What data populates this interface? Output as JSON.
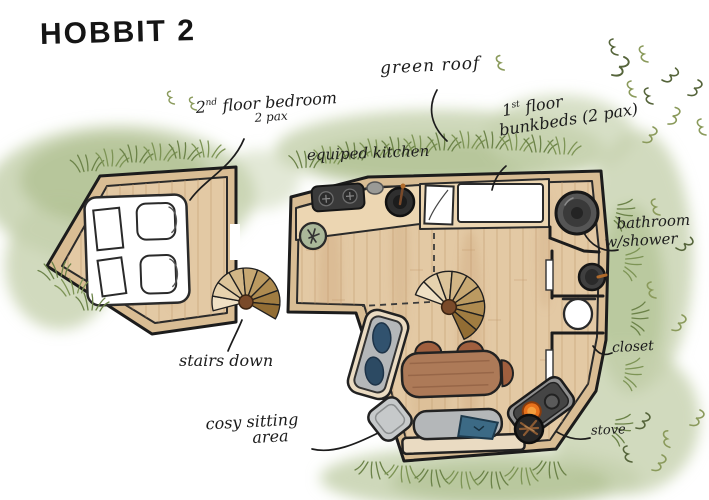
{
  "title": "HOBBIT 2",
  "labels": {
    "bedroom": {
      "ordinal": "2",
      "suffix": "nd",
      "rest": " floor bedroom",
      "capacity": "2 pax"
    },
    "green_roof": "green roof",
    "kitchen": "equiped kitchen",
    "bunkbeds": {
      "ordinal": "1",
      "suffix": "st",
      "rest": " floor",
      "line2": "bunkbeds (2 pax)"
    },
    "bathroom": {
      "line1": "bathroom",
      "line2": "w/shower"
    },
    "closet": "closet",
    "stairs": "stairs down",
    "sitting": {
      "line1": "cosy sitting",
      "line2": "area"
    },
    "stove": "stove"
  },
  "fixtures": [
    "double bed",
    "spiral stairs",
    "kitchen counter",
    "cooktop",
    "kitchen sink",
    "side table",
    "bunk bed",
    "shower",
    "washbasin",
    "toilet",
    "sofa",
    "ottoman",
    "dining table",
    "chairs",
    "bench",
    "wood stove",
    "firewood basket"
  ],
  "colors": {
    "ink": "#1f1f1f",
    "paper": "#ffffff",
    "wall_tan": "#d9bd94",
    "wood_floor": "#e3c9a4",
    "wood_grain": "#c09a6e",
    "grass_light": "#c6d1ae",
    "grass_mid": "#a8bb87",
    "grass_stroke": "#6b8248",
    "grass_dark": "#55643a",
    "appliance_dark": "#3a3a3a",
    "stove_fire": "#e8721c",
    "sofa_gray": "#b4b7b9",
    "pillow_blue": "#31526e",
    "table_brown": "#ad7a58",
    "stair_wood": "#c9a472"
  }
}
